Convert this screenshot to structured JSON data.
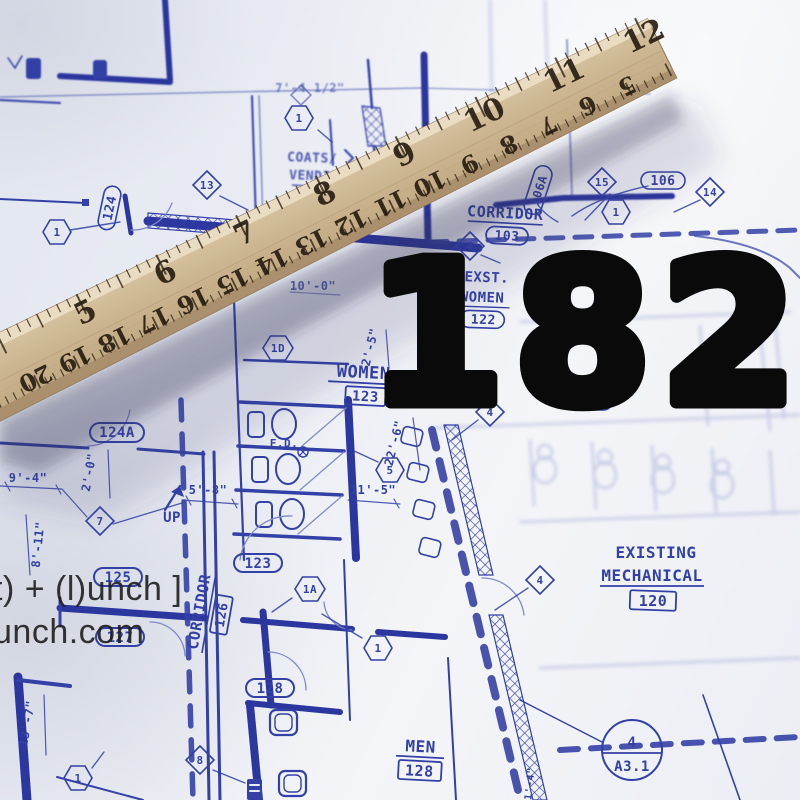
{
  "overlay": {
    "number": "182",
    "color": "#0a0a0a"
  },
  "watermark": {
    "line1": "t) + (l)unch ]",
    "line2": "unch.com"
  },
  "ruler": {
    "numbers_top": [
      "5",
      "6",
      "7",
      "8",
      "9",
      "10",
      "11",
      "12"
    ],
    "numbers_bottom": [
      "20",
      "19",
      "18",
      "17",
      "16",
      "15",
      "14",
      "13",
      "12",
      "11",
      "10",
      "9",
      "8",
      "7",
      "6",
      "5"
    ],
    "wood_color": "#cdb593"
  },
  "blueprint": {
    "ink_color": "#3340a6",
    "labels": {
      "coats_line1": "COATS/",
      "coats_line2": "VENDIN",
      "corridor103_name": "CORRIDOR",
      "corridor103_num": "103",
      "room106a": "106A",
      "room106": "106",
      "exst_line1": "EXST.",
      "exst_line2": "WOMEN",
      "exst_num": "122",
      "women_name": "WOMEN",
      "women_num": "123",
      "room121": "121",
      "room124": "124",
      "room124a": "124A",
      "room125": "125",
      "room127": "127",
      "room123_tag": "123",
      "room128_tag": "128",
      "corridor126_name": "CORRIDOR",
      "corridor126_num": "126",
      "up": "UP",
      "fd": "F.D.",
      "men_name": "MEN",
      "men_num": "128",
      "existing_line1": "EXISTING",
      "existing_line2": "MECHANICAL",
      "existing_num": "120",
      "section_top": "4",
      "section_bottom": "A3.1",
      "dim_7_4": "7'-4 1/2\"",
      "dim_10_0": "10'-0\"",
      "dim_2_5": "2'-5\"",
      "dim_2_0": "2'-0\"",
      "dim_9_4": "9'-4\"",
      "dim_8_11": "8'-11\"",
      "dim_5_8": "5'-8\"",
      "dim_11_5": "11'-5\"",
      "dim_22_6": "22'-6\"",
      "dim_13_7": "13'-7\"",
      "dim_1_4": "1'-4\""
    },
    "markers": {
      "h1": "1",
      "h5": "5",
      "h1d": "1D",
      "h1a": "1A",
      "d7": "7",
      "d13": "13",
      "d14": "14",
      "d15": "15",
      "d4": "4",
      "d8": "8"
    }
  }
}
